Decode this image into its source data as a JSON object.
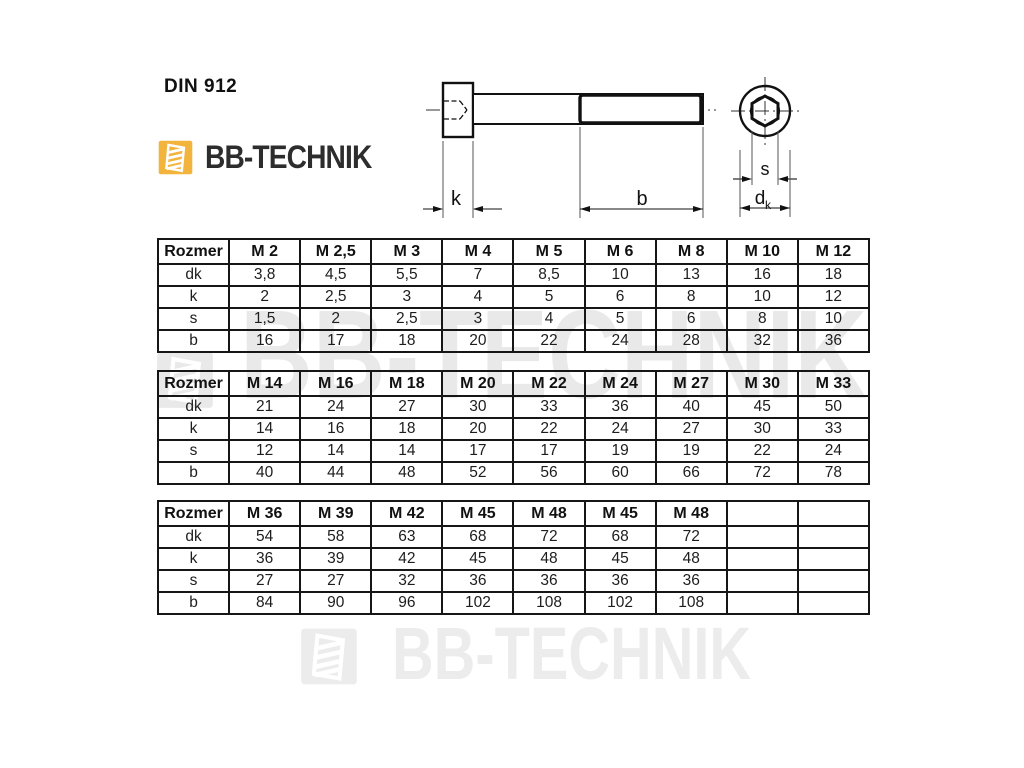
{
  "page": {
    "title": "DIN 912"
  },
  "brand": {
    "name": "BB-TECHNIK",
    "logo_color": "#F2B43C",
    "text_color": "#2D2D2D"
  },
  "watermark": {
    "middle": "BB-TECHNIK",
    "bottom": "BB-TECHNIK",
    "color": "#e9e9e9"
  },
  "drawing": {
    "labels": {
      "k": "k",
      "b": "b",
      "s": "s",
      "d": "d",
      "d_sub": "k"
    }
  },
  "tables": [
    {
      "header": [
        "Rozmer",
        "M 2",
        "M 2,5",
        "M 3",
        "M 4",
        "M 5",
        "M 6",
        "M 8",
        "M 10",
        "M 12"
      ],
      "rows": [
        [
          "dk",
          "3,8",
          "4,5",
          "5,5",
          "7",
          "8,5",
          "10",
          "13",
          "16",
          "18"
        ],
        [
          "k",
          "2",
          "2,5",
          "3",
          "4",
          "5",
          "6",
          "8",
          "10",
          "12"
        ],
        [
          "s",
          "1,5",
          "2",
          "2,5",
          "3",
          "4",
          "5",
          "6",
          "8",
          "10"
        ],
        [
          "b",
          "16",
          "17",
          "18",
          "20",
          "22",
          "24",
          "28",
          "32",
          "36"
        ]
      ]
    },
    {
      "header": [
        "Rozmer",
        "M 14",
        "M 16",
        "M 18",
        "M 20",
        "M 22",
        "M 24",
        "M 27",
        "M 30",
        "M 33"
      ],
      "rows": [
        [
          "dk",
          "21",
          "24",
          "27",
          "30",
          "33",
          "36",
          "40",
          "45",
          "50"
        ],
        [
          "k",
          "14",
          "16",
          "18",
          "20",
          "22",
          "24",
          "27",
          "30",
          "33"
        ],
        [
          "s",
          "12",
          "14",
          "14",
          "17",
          "17",
          "19",
          "19",
          "22",
          "24"
        ],
        [
          "b",
          "40",
          "44",
          "48",
          "52",
          "56",
          "60",
          "66",
          "72",
          "78"
        ]
      ]
    },
    {
      "header": [
        "Rozmer",
        "M 36",
        "M 39",
        "M 42",
        "M 45",
        "M 48",
        "M 45",
        "M 48",
        "",
        ""
      ],
      "rows": [
        [
          "dk",
          "54",
          "58",
          "63",
          "68",
          "72",
          "68",
          "72",
          "",
          ""
        ],
        [
          "k",
          "36",
          "39",
          "42",
          "45",
          "48",
          "45",
          "48",
          "",
          ""
        ],
        [
          "s",
          "27",
          "27",
          "32",
          "36",
          "36",
          "36",
          "36",
          "",
          ""
        ],
        [
          "b",
          "84",
          "90",
          "96",
          "102",
          "108",
          "102",
          "108",
          "",
          ""
        ]
      ]
    }
  ]
}
